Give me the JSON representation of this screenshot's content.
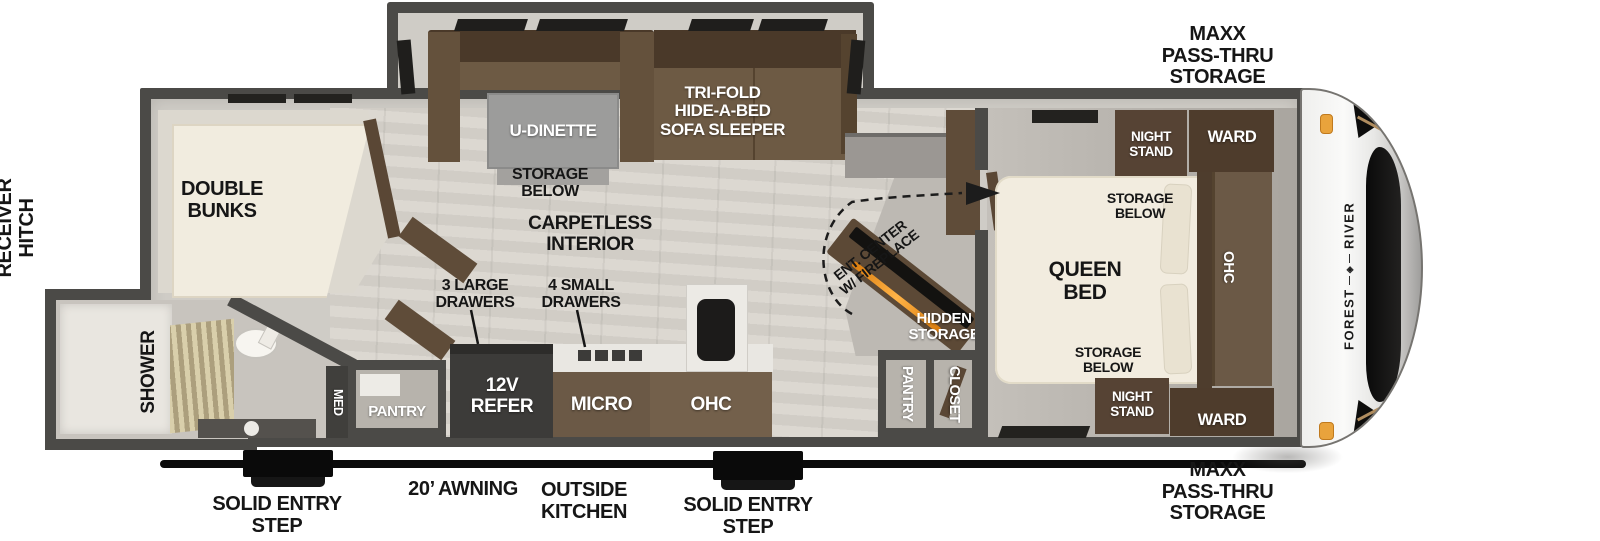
{
  "exterior": {
    "receiver_hitch": "RECEIVER\nHITCH",
    "maxx_storage_top": "MAXX\nPASS-THRU\nSTORAGE",
    "maxx_storage_bottom": "MAXX\nPASS-THRU\nSTORAGE",
    "awning": "20’ AWNING",
    "outside_kitchen": "OUTSIDE\nKITCHEN",
    "entry_step_left": "SOLID ENTRY\nSTEP",
    "entry_step_right": "SOLID ENTRY\nSTEP",
    "brand_word1": "FOREST",
    "brand_word2": "RIVER"
  },
  "rooms": {
    "bunk_room": {
      "label": "DOUBLE\nBUNKS"
    },
    "bathroom": {
      "shower": "SHOWER",
      "med": "MED",
      "pantry": "PANTRY"
    },
    "living": {
      "dinette": "U-DINETTE",
      "dinette_storage": "STORAGE\nBELOW",
      "sofa": "TRI-FOLD\nHIDE-A-BED\nSOFA SLEEPER",
      "flooring": "CARPETLESS\nINTERIOR",
      "ent_center": "ENT. CENTER\nW/ FIREPLACE",
      "hidden_storage": "HIDDEN\nSTORAGE",
      "pantry": "PANTRY",
      "closet": "CLOSET"
    },
    "kitchen": {
      "large_drawers": "3 LARGE\nDRAWERS",
      "small_drawers": "4 SMALL\nDRAWERS",
      "refer": "12V\nREFER",
      "micro": "MICRO",
      "ohc": "OHC"
    },
    "bedroom": {
      "bed": "QUEEN\nBED",
      "storage_below_top": "STORAGE\nBELOW",
      "storage_below_bottom": "STORAGE\nBELOW",
      "night_stand_top": "NIGHT\nSTAND",
      "night_stand_bottom": "NIGHT\nSTAND",
      "ward_top": "WARD",
      "ward_bottom": "WARD",
      "ohc": "OHC"
    }
  },
  "colors": {
    "wall_gray": "#4b4a47",
    "furniture_brown": "#5f4c39",
    "cabinet_brown": "#6b5946",
    "bed_cream": "#f2ecdf",
    "marker_amber": "#e9a33c",
    "fireplace_orange": "#e8860f",
    "label_black": "#161616",
    "label_white": "#ffffff"
  }
}
